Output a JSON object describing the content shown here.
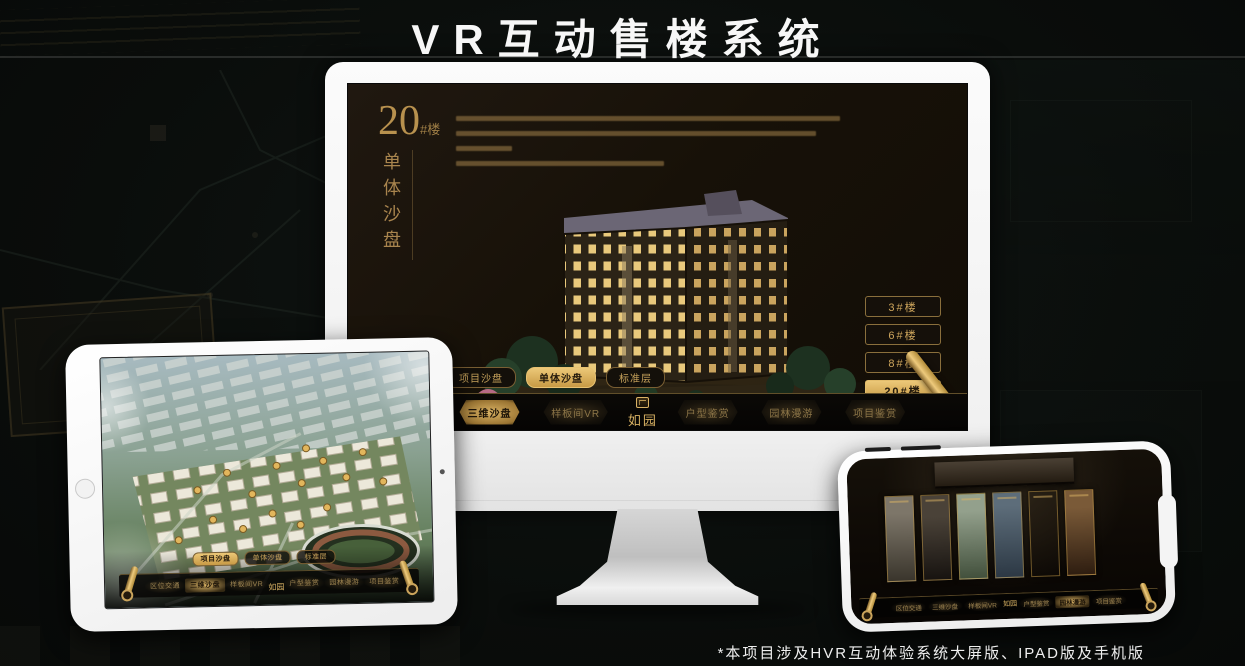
{
  "page": {
    "title": "VR互动售楼系统",
    "footnote": "*本项目涉及HVR互动体验系统大屏版、IPAD版及手机版"
  },
  "colors": {
    "gold_accent": "#d8ae5f",
    "screen_bg": "#171108",
    "page_bg": "#0a0d0b",
    "device_body": "#f4f4f4"
  },
  "detail_panel": {
    "building_number": "20",
    "building_suffix": "#楼",
    "subtitle": "单体沙盘",
    "buttons": [
      "3#楼",
      "6#楼",
      "8#楼",
      "20#楼"
    ],
    "active_button": "20#楼"
  },
  "sub_tabs": [
    "项目沙盘",
    "单体沙盘",
    "标准层"
  ],
  "nav": {
    "logo": "如园",
    "items": [
      "区位交通",
      "三维沙盘",
      "样板间VR",
      "户型鉴赏",
      "园林漫游",
      "项目鉴赏"
    ]
  },
  "icons": {
    "scroll_handle": "scroll-handle-icon",
    "seal_logo": "seal-logo-icon",
    "home_button": "home-button",
    "camera": "camera-dot"
  }
}
